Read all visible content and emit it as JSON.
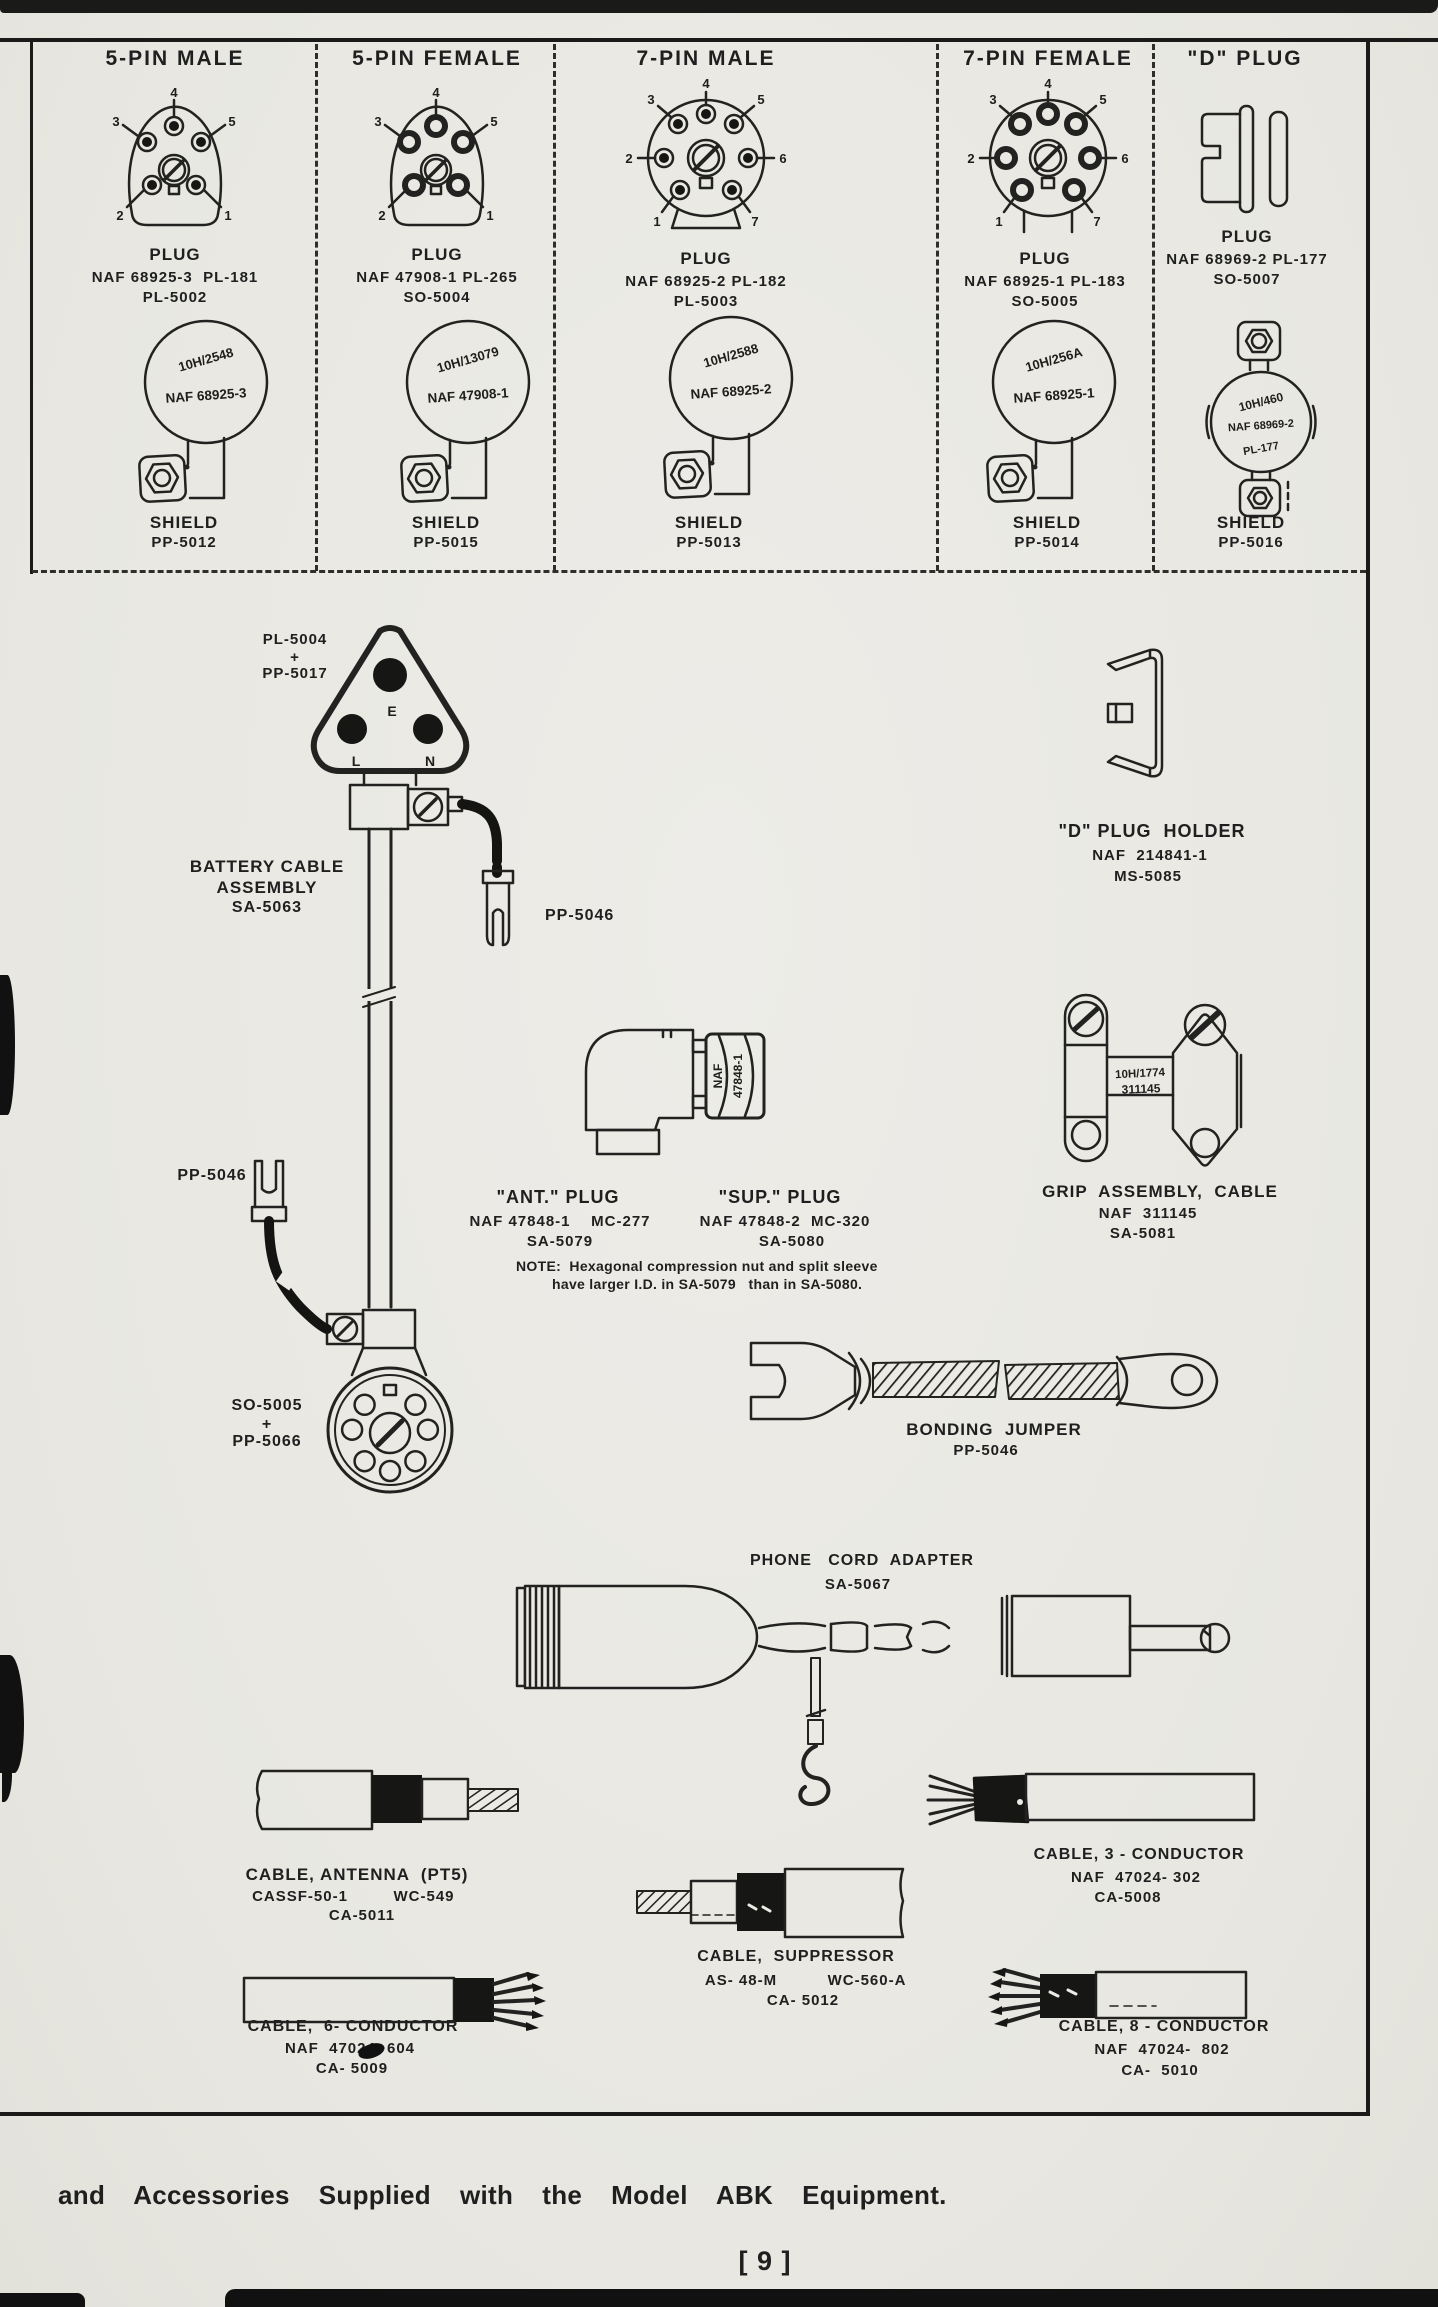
{
  "colors": {
    "paper": "#ebeae5",
    "ink": "#1f1f1f"
  },
  "table": {
    "columns": [
      {
        "header": "5-PIN MALE",
        "pins": [
          "4",
          "3",
          "5",
          "2",
          "1"
        ],
        "plug_label": "PLUG",
        "plug_line1": "NAF 68925-3  PL-181",
        "plug_line2": "PL-5002",
        "stamp1": "10H/2548",
        "stamp2": "NAF 68925-3",
        "shield_label": "SHIELD",
        "shield_part": "PP-5012"
      },
      {
        "header": "5-PIN FEMALE",
        "pins": [
          "4",
          "3",
          "5",
          "2",
          "1"
        ],
        "plug_label": "PLUG",
        "plug_line1": "NAF 47908-1 PL-265",
        "plug_line2": "SO-5004",
        "stamp1": "10H/13079",
        "stamp2": "NAF 47908-1",
        "shield_label": "SHIELD",
        "shield_part": "PP-5015"
      },
      {
        "header": "7-PIN MALE",
        "pins": [
          "4",
          "3",
          "5",
          "2",
          "6",
          "1",
          "7"
        ],
        "plug_label": "PLUG",
        "plug_line1": "NAF 68925-2 PL-182",
        "plug_line2": "PL-5003",
        "stamp1": "10H/2588",
        "stamp2": "NAF 68925-2",
        "shield_label": "SHIELD",
        "shield_part": "PP-5013"
      },
      {
        "header": "7-PIN FEMALE",
        "pins": [
          "4",
          "3",
          "5",
          "2",
          "6",
          "1",
          "7"
        ],
        "plug_label": "PLUG",
        "plug_line1": "NAF 68925-1 PL-183",
        "plug_line2": "SO-5005",
        "stamp1": "10H/256A",
        "stamp2": "NAF 68925-1",
        "shield_label": "SHIELD",
        "shield_part": "PP-5014"
      },
      {
        "header": "\"D\" PLUG",
        "pins": [],
        "plug_label": "PLUG",
        "plug_line1": "NAF 68969-2 PL-177",
        "plug_line2": "SO-5007",
        "stamp1": "10H/460",
        "stamp2": "NAF 68969-2",
        "stamp3": "PL-177",
        "shield_label": "SHIELD",
        "shield_part": "PP-5016"
      }
    ]
  },
  "battery": {
    "top1": "PL-5004",
    "plus": "+",
    "top2": "PP-5017",
    "pin_e": "E",
    "pin_l": "L",
    "pin_n": "N",
    "name1": "BATTERY CABLE",
    "name2": "ASSEMBLY",
    "name3": "SA-5063",
    "fork_right": "PP-5046",
    "fork_left": "PP-5046",
    "bot1": "SO-5005",
    "bot_plus": "+",
    "bot2": "PP-5066"
  },
  "d_holder": {
    "title": "\"D\" PLUG  HOLDER",
    "line1": "NAF  214841-1",
    "line2": "MS-5085"
  },
  "elbow": {
    "nut_line1": "NAF",
    "nut_line2": "47848-1",
    "ant_title": "\"ANT.\" PLUG",
    "ant_line1": "NAF 47848-1    MC-277",
    "ant_line2": "SA-5079",
    "sup_title": "\"SUP.\" PLUG",
    "sup_line1": "NAF 47848-2  MC-320",
    "sup_line2": "SA-5080",
    "note_line1": "NOTE:  Hexagonal compression nut and split sleeve",
    "note_line2": "have larger I.D. in SA-5079   than in SA-5080."
  },
  "grip": {
    "stamp1": "10H/1774",
    "stamp2": "311145",
    "title": "GRIP  ASSEMBLY,  CABLE",
    "line1": "NAF  311145",
    "line2": "SA-5081"
  },
  "bonding": {
    "title": "BONDING  JUMPER",
    "line1": "PP-5046"
  },
  "phone": {
    "title": "PHONE   CORD  ADAPTER",
    "line1": "SA-5067"
  },
  "cable_antenna": {
    "title": "CABLE, ANTENNA  (PT5)",
    "part_a": "CASSF-50-1",
    "part_b": "WC-549",
    "line2": "CA-5011"
  },
  "cable_3": {
    "title": "CABLE, 3 - CONDUCTOR",
    "line1": "NAF  47024- 302",
    "line2": "CA-5008"
  },
  "cable_sup": {
    "title": "CABLE,  SUPPRESSOR",
    "part_a": "AS- 48-M",
    "part_b": "WC-560-A",
    "line2": "CA- 5012"
  },
  "cable_6": {
    "title": "CABLE,  6- CONDUCTOR",
    "line1": "NAF  47024- 604",
    "line2": "CA- 5009"
  },
  "cable_8": {
    "title": "CABLE, 8 - CONDUCTOR",
    "line1": "NAF  47024-  802",
    "line2": "CA-  5010"
  },
  "footer": {
    "caption": "and  Accessories  Supplied  with  the  Model  ABK  Equipment.",
    "page_number": "[ 9 ]"
  }
}
